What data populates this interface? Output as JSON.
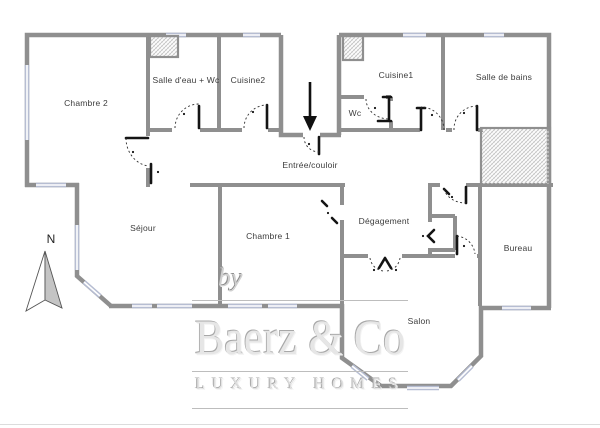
{
  "rooms": {
    "chambre2": {
      "label": "Chambre 2"
    },
    "salle_deau": {
      "label": "Salle d'eau + Wc"
    },
    "cuisine2": {
      "label": "Cuisine2"
    },
    "cuisine1": {
      "label": "Cuisine1"
    },
    "wc": {
      "label": "Wc"
    },
    "salle_de_bains": {
      "label": "Salle de bains"
    },
    "entree": {
      "label": "Entrée/couloir"
    },
    "sejour": {
      "label": "Séjour"
    },
    "chambre1": {
      "label": "Chambre 1"
    },
    "degagement": {
      "label": "Dégagement"
    },
    "bureau": {
      "label": "Bureau"
    },
    "salon": {
      "label": "Salon"
    }
  },
  "compass": {
    "label": "N"
  },
  "watermark": {
    "prefix": "by",
    "brand": "Baerz & Co",
    "tagline": "LUXURY HOMES"
  },
  "icons": {
    "entrance_arrow": "down-arrow entrance marker",
    "compass": "north compass needle",
    "shaft_hatch": "hatched technical shaft"
  },
  "colors": {
    "background": "#ffffff",
    "wall": "#8f8f8f",
    "window": "#b6bdd2",
    "door": "#141414",
    "hatch": "#c4c4c4",
    "watermark": "#e6e6e6"
  }
}
